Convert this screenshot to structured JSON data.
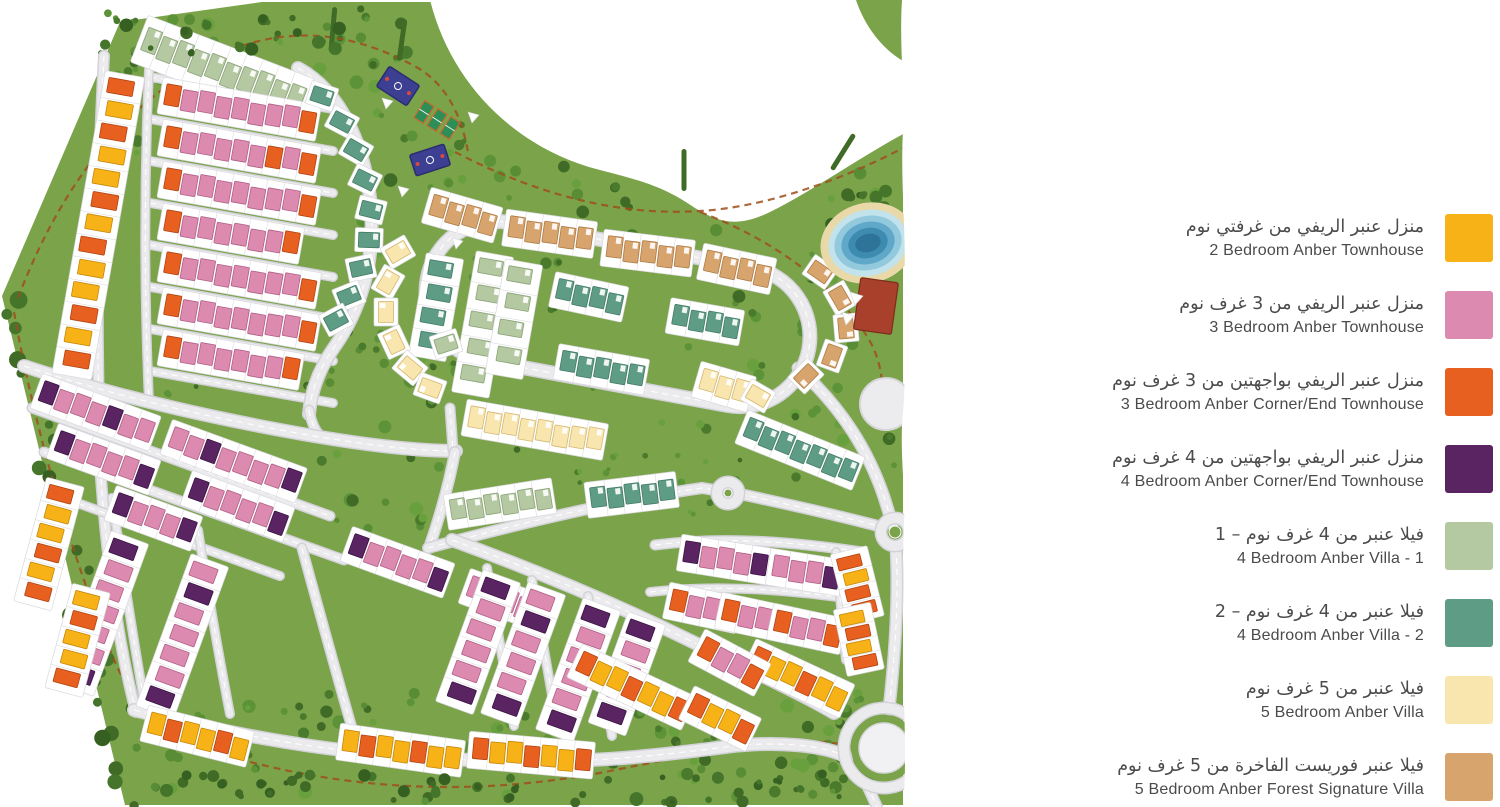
{
  "legend": {
    "items": [
      {
        "ar": "منزل عنبر الريفي من غرفتي نوم",
        "en": "2 Bedroom Anber Townhouse",
        "color": "#F7B217"
      },
      {
        "ar": "منزل عنبر الريفي من 3 غرف نوم",
        "en": "3 Bedroom Anber Townhouse",
        "color": "#DC8AB0"
      },
      {
        "ar": "منزل عنبر الريفي بواجهتين من 3 غرف نوم",
        "en": "3 Bedroom Anber Corner/End Townhouse",
        "color": "#E7601F"
      },
      {
        "ar": "منزل عنبر الريفي بواجهتين من 4 غرف نوم",
        "en": "4 Bedroom Anber Corner/End Townhouse",
        "color": "#5A2463"
      },
      {
        "ar": "فيلا عنبر من 4 غرف نوم – 1",
        "en": "4 Bedroom Anber Villa - 1",
        "color": "#B4C8A1"
      },
      {
        "ar": "فيلا عنبر من 4 غرف نوم – 2",
        "en": "4 Bedroom Anber Villa - 2",
        "color": "#5F9C86"
      },
      {
        "ar": "فيلا عنبر من 5 غرف نوم",
        "en": "5 Bedroom Anber Villa",
        "color": "#F9E5AE"
      },
      {
        "ar": "فيلا عنبر فوريست الفاخرة من 5 غرف نوم",
        "en": "5 Bedroom Anber Forest Signature Villa",
        "color": "#D8A46E"
      }
    ]
  },
  "map": {
    "bg": "#7BA34A",
    "page": "#ffffff",
    "road": {
      "casing": "#d2d2d8",
      "fill": "#ebebee",
      "dash": "#ffffff"
    },
    "trail_color": "#9f4f1d",
    "tree_colors": [
      "#4a7a2c",
      "#588c35",
      "#69a03e",
      "#3f6b26",
      "#5d9338"
    ],
    "dark_trees": [
      "#3f6b26",
      "#44752a",
      "#356022"
    ],
    "palette": {
      "Y": [
        "#F7B217",
        "#c4870a"
      ],
      "P": [
        "#DC8AB0",
        "#b05f85"
      ],
      "O": [
        "#E7601F",
        "#b04312"
      ],
      "U": [
        "#5A2463",
        "#3a1342"
      ],
      "S": [
        "#B4C8A1",
        "#8ba277"
      ],
      "T": [
        "#5F9C86",
        "#437b66"
      ],
      "C": [
        "#F9E5AE",
        "#d3b873"
      ],
      "N": [
        "#D8A46E",
        "#ad7b45"
      ]
    },
    "outline": "M 120,22 L 262,2 L 903,2 L 903,805 L 125,805 L 2,296 Z",
    "blob": "M 430,0 C 452,88 520,150 600,170 C 642,181 662,186 692,206 C 722,226 742,226 772,211 C 812,191 862,156 905,133 L 905,0 Z",
    "wedge": "M 856,0 C 866,30 886,52 905,62 L 905,0 Z",
    "blob_pts": [
      [
        425,
        0
      ],
      [
        500,
        118
      ],
      [
        560,
        158
      ],
      [
        620,
        172
      ],
      [
        680,
        200
      ],
      [
        740,
        218
      ],
      [
        800,
        196
      ],
      [
        860,
        162
      ],
      [
        905,
        133
      ]
    ],
    "edge": "M 902,0 C 899,45 905,90 903,130 C 900,185 907,235 904,290 C 901,340 907,375 903,412 C 899,452 906,492 904,522 C 902,560 906,600 904,640 C 902,700 908,750 903,807 L 920,807 L 920,0 Z",
    "trails": [
      "M 18,298 C 55,200 115,110 205,62 C 280,22 350,30 418,68 C 448,86 462,118 468,152",
      "M 455,152 C 540,196 620,216 700,211 C 770,207 850,176 903,148",
      "M 700,212 C 775,240 838,288 868,338 C 883,362 884,390 881,414",
      "M 14,312 C 35,430 70,550 110,650 C 125,688 144,716 170,737",
      "M 170,737 C 320,792 470,800 620,769 C 720,749 792,733 851,746"
    ],
    "roads": [
      {
        "d": "M 150,77 L 333,109",
        "w": 7
      },
      {
        "d": "M 150,119 L 333,151",
        "w": 7
      },
      {
        "d": "M 150,161 L 333,193",
        "w": 7
      },
      {
        "d": "M 150,203 L 333,235",
        "w": 7
      },
      {
        "d": "M 150,245 L 333,277",
        "w": 7
      },
      {
        "d": "M 150,287 L 333,319",
        "w": 7
      },
      {
        "d": "M 150,329 L 333,361",
        "w": 7
      },
      {
        "d": "M 150,371 L 333,403",
        "w": 7
      },
      {
        "d": "M 298,68 C 342,92 366,148 371,208 C 375,266 359,312 335,346 C 318,370 311,392 309,414",
        "w": 11
      },
      {
        "d": "M 309,410 C 312,426 317,434 324,439",
        "w": 8
      },
      {
        "d": "M 104,56 C 97,180 96,320 100,448",
        "w": 9
      },
      {
        "d": "M 149,70 C 144,180 144,290 149,402",
        "w": 7
      },
      {
        "d": "M 24,366 C 120,398 220,420 320,437 C 380,447 426,451 456,451",
        "w": 11
      },
      {
        "d": "M 99,446 C 104,540 117,640 136,712",
        "w": 9
      },
      {
        "d": "M 134,710 C 260,742 360,756 470,760 C 580,765 655,756 725,747 C 780,740 826,746 847,757",
        "w": 11
      },
      {
        "d": "M 867,785 L 877,807",
        "w": 9
      },
      {
        "d": "M 32,408 C 130,444 230,480 330,516",
        "w": 8
      },
      {
        "d": "M 44,452 C 144,488 244,524 344,560",
        "w": 8
      },
      {
        "d": "M 58,496 C 132,523 206,550 280,576",
        "w": 7
      },
      {
        "d": "M 112,498 C 122,565 132,632 144,700",
        "w": 7
      },
      {
        "d": "M 198,530 C 208,592 218,652 230,714",
        "w": 7
      },
      {
        "d": "M 302,548 C 320,614 338,680 356,742",
        "w": 8
      },
      {
        "d": "M 450,408 L 453,450",
        "w": 8
      },
      {
        "d": "M 455,452 C 449,484 440,516 429,548",
        "w": 9
      },
      {
        "d": "M 428,548 C 525,522 618,500 702,488 L 726,492",
        "w": 9
      },
      {
        "d": "M 452,540 C 540,572 625,608 705,648 C 758,674 802,694 834,713",
        "w": 11
      },
      {
        "d": "M 487,568 C 496,622 505,676 514,726",
        "w": 7
      },
      {
        "d": "M 532,580 C 541,630 549,678 557,724",
        "w": 7
      },
      {
        "d": "M 588,596 C 597,644 605,692 612,736",
        "w": 7
      },
      {
        "d": "M 655,545 C 725,536 795,542 862,552",
        "w": 8
      },
      {
        "d": "M 650,592 C 722,584 794,590 858,600",
        "w": 7
      },
      {
        "d": "M 740,494 C 792,505 840,516 882,527",
        "w": 9
      },
      {
        "d": "M 798,368 C 842,408 868,450 884,497 C 888,510 891,519 892,524",
        "w": 10
      },
      {
        "d": "M 896,547 C 899,600 895,655 889,709",
        "w": 10
      },
      {
        "d": "M 909,531 L 920,529",
        "w": 9
      },
      {
        "d": "M 836,552 C 840,590 842,625 846,660",
        "w": 7
      }
    ],
    "loop": {
      "x": 424,
      "y": 244,
      "w": 388,
      "h": 140,
      "r": 70,
      "rot": 10.5,
      "cx": 618,
      "cy": 314
    },
    "roundabouts": [
      {
        "cx": 728,
        "cy": 493,
        "r": 11,
        "ir": 4,
        "disc": false
      },
      {
        "cx": 895,
        "cy": 532,
        "r": 14,
        "ir": 6,
        "disc": false
      },
      {
        "cx": 884,
        "cy": 748,
        "r": 40,
        "ir": 25,
        "disc": true
      }
    ],
    "clusters": [
      {
        "x": 143,
        "y": 40,
        "rot": 21,
        "p": "SSSSSSSSSS",
        "uh": 24,
        "deep": true
      },
      {
        "x": 124,
        "y": 80,
        "rot": 10,
        "axis": "v",
        "p": "OYOYYOYOYYOYO",
        "uw": 26,
        "uh": 15,
        "pv": 23
      },
      {
        "x": 164,
        "y": 96,
        "rot": 10,
        "p": "OPPPPPPPO"
      },
      {
        "x": 164,
        "y": 138,
        "rot": 10,
        "p": "OPPPPPOPO"
      },
      {
        "x": 164,
        "y": 180,
        "rot": 10,
        "p": "OPPPPPPPO"
      },
      {
        "x": 164,
        "y": 222,
        "rot": 10,
        "p": "OPPPPPPO"
      },
      {
        "x": 164,
        "y": 264,
        "rot": 10,
        "p": "OPPPPPPPO"
      },
      {
        "x": 164,
        "y": 306,
        "rot": 10,
        "p": "OPPPPPPPO"
      },
      {
        "x": 164,
        "y": 348,
        "rot": 10,
        "p": "OPPPPPPO"
      },
      {
        "x": 40,
        "y": 392,
        "rot": 20,
        "p": "UPPPUPP"
      },
      {
        "x": 170,
        "y": 438,
        "rot": 20,
        "p": "PPUPPPPU"
      },
      {
        "x": 56,
        "y": 442,
        "rot": 20,
        "p": "UPPPPU"
      },
      {
        "x": 190,
        "y": 489,
        "rot": 20,
        "p": "UPPPPU"
      },
      {
        "x": 350,
        "y": 545,
        "rot": 20,
        "p": "UPPPPU"
      },
      {
        "x": 468,
        "y": 587,
        "rot": 20,
        "p": "PUPPU"
      },
      {
        "x": 114,
        "y": 504,
        "rot": 20,
        "p": "UPPPU"
      },
      {
        "x": 128,
        "y": 543,
        "rot": 20,
        "axis": "v",
        "p": "UPPPPPU",
        "uw": 26,
        "uh": 15,
        "pv": 22
      },
      {
        "x": 208,
        "y": 566,
        "rot": 20,
        "axis": "v",
        "p": "PUPPPPU",
        "uw": 26,
        "uh": 15,
        "pv": 22
      },
      {
        "x": 500,
        "y": 582,
        "rot": 20,
        "axis": "v",
        "p": "UPPPPU",
        "uw": 26,
        "uh": 15,
        "pv": 22
      },
      {
        "x": 545,
        "y": 594,
        "rot": 20,
        "axis": "v",
        "p": "PUPPPU",
        "uw": 26,
        "uh": 15,
        "pv": 22
      },
      {
        "x": 600,
        "y": 610,
        "rot": 20,
        "axis": "v",
        "p": "UPPPPU",
        "uw": 26,
        "uh": 15,
        "pv": 22
      },
      {
        "x": 645,
        "y": 624,
        "rot": 20,
        "axis": "v",
        "p": "UPPPU",
        "uw": 26,
        "uh": 15,
        "pv": 22
      },
      {
        "x": 64,
        "y": 488,
        "rot": 15,
        "axis": "v",
        "p": "OYYOYO",
        "uw": 25,
        "uh": 14,
        "pv": 20
      },
      {
        "x": 90,
        "y": 594,
        "rot": 15,
        "axis": "v",
        "p": "YOYYO",
        "uw": 25,
        "uh": 14,
        "pv": 20
      },
      {
        "x": 148,
        "y": 724,
        "rot": 14,
        "p": "YOYYOY"
      },
      {
        "x": 342,
        "y": 742,
        "rot": 8,
        "p": "YOYYOYY"
      },
      {
        "x": 472,
        "y": 750,
        "rot": 5,
        "p": "OYYOYYO"
      },
      {
        "x": 578,
        "y": 662,
        "rot": 25,
        "p": "OYYOYYO"
      },
      {
        "x": 690,
        "y": 704,
        "rot": 26,
        "p": "OYYO"
      },
      {
        "x": 752,
        "y": 657,
        "rot": 25,
        "p": "OYYOYY"
      },
      {
        "x": 683,
        "y": 553,
        "rot": 9,
        "p": "UPPPU"
      },
      {
        "x": 772,
        "y": 567,
        "rot": 9,
        "p": "PPPU"
      },
      {
        "x": 670,
        "y": 601,
        "rot": 12,
        "p": "OPPO"
      },
      {
        "x": 722,
        "y": 611,
        "rot": 12,
        "p": "OPPO"
      },
      {
        "x": 774,
        "y": 622,
        "rot": 12,
        "p": "OPPO"
      },
      {
        "x": 700,
        "y": 647,
        "rot": 28,
        "p": "OPPO"
      },
      {
        "x": 850,
        "y": 556,
        "rot": -14,
        "axis": "v",
        "p": "OYOO",
        "uw": 24,
        "uh": 12,
        "pv": 16
      },
      {
        "x": 853,
        "y": 612,
        "rot": -12,
        "axis": "v",
        "p": "YOYO",
        "uw": 24,
        "uh": 12,
        "pv": 15
      },
      {
        "x": 450,
        "y": 512,
        "rot": -9,
        "p": "SSSSSS",
        "uh": 20
      },
      {
        "x": 590,
        "y": 500,
        "rot": -7,
        "p": "TTTTT",
        "uh": 20
      },
      {
        "x": 745,
        "y": 428,
        "rot": 22,
        "p": "TTTTTTT",
        "uh": 20
      },
      {
        "x": 444,
        "y": 262,
        "rot": 10,
        "axis": "v",
        "p": "TTTT",
        "uw": 24,
        "uh": 15,
        "pv": 24
      },
      {
        "x": 494,
        "y": 260,
        "rot": 10,
        "axis": "v",
        "p": "SSSSS",
        "uw": 24,
        "uh": 15,
        "pv": 27
      },
      {
        "x": 523,
        "y": 268,
        "rot": 10,
        "axis": "v",
        "p": "SSSS",
        "uw": 24,
        "uh": 15,
        "pv": 27
      },
      {
        "x": 556,
        "y": 290,
        "rot": 12,
        "p": "TTTT",
        "uh": 20
      },
      {
        "x": 672,
        "y": 316,
        "rot": 10,
        "p": "TTTT",
        "uh": 20
      },
      {
        "x": 560,
        "y": 362,
        "rot": 10,
        "p": "TTTTT",
        "uh": 20
      },
      {
        "x": 468,
        "y": 418,
        "rot": 10,
        "p": "CCCCCCCC"
      },
      {
        "x": 700,
        "y": 380,
        "rot": 16,
        "p": "CCC"
      },
      {
        "x": 430,
        "y": 206,
        "rot": 16,
        "p": "NNNN"
      },
      {
        "x": 508,
        "y": 228,
        "rot": 8,
        "p": "NNNNN"
      },
      {
        "x": 606,
        "y": 248,
        "rot": 7,
        "p": "NNNNN"
      },
      {
        "x": 704,
        "y": 262,
        "rot": 12,
        "p": "NNNN"
      }
    ],
    "singles": [
      [
        322,
        96,
        18,
        "T"
      ],
      [
        342,
        122,
        28,
        "T"
      ],
      [
        356,
        150,
        30,
        "T"
      ],
      [
        365,
        180,
        26,
        "T"
      ],
      [
        371,
        210,
        14,
        "T"
      ],
      [
        369,
        240,
        2,
        "T"
      ],
      [
        361,
        268,
        -12,
        "T"
      ],
      [
        349,
        296,
        -22,
        "T"
      ],
      [
        336,
        320,
        -28,
        "T"
      ],
      [
        820,
        272,
        35,
        "N"
      ],
      [
        840,
        298,
        60,
        "N"
      ],
      [
        846,
        328,
        85,
        "N"
      ],
      [
        832,
        356,
        110,
        "N"
      ],
      [
        806,
        376,
        135,
        "N"
      ],
      [
        398,
        252,
        -30,
        "C"
      ],
      [
        388,
        282,
        -60,
        "C"
      ],
      [
        386,
        312,
        -90,
        "C"
      ],
      [
        394,
        342,
        -115,
        "C"
      ],
      [
        410,
        368,
        -140,
        "C"
      ],
      [
        430,
        388,
        -160,
        "C"
      ],
      [
        758,
        396,
        30,
        "C"
      ],
      [
        446,
        344,
        -18,
        "S"
      ]
    ],
    "tree_zones": [
      {
        "x": 95,
        "y": 8,
        "w": 320,
        "h": 85,
        "n": 38
      },
      {
        "x": 360,
        "y": 85,
        "w": 290,
        "h": 185,
        "n": 55
      },
      {
        "x": 700,
        "y": 168,
        "w": 200,
        "h": 310,
        "n": 55
      },
      {
        "x": 320,
        "y": 330,
        "w": 150,
        "h": 215,
        "n": 30
      },
      {
        "x": 130,
        "y": 690,
        "w": 750,
        "h": 112,
        "n": 80
      },
      {
        "x": 440,
        "y": 250,
        "w": 360,
        "h": 200,
        "n": 20,
        "small": true
      },
      {
        "x": 845,
        "y": 2,
        "w": 58,
        "h": 62,
        "n": 14,
        "dark": true
      },
      {
        "x": 140,
        "y": 360,
        "w": 190,
        "h": 48,
        "n": 12,
        "small": true
      },
      {
        "x": 820,
        "y": 185,
        "w": 85,
        "h": 50,
        "n": 18,
        "dark": true
      },
      {
        "x": 540,
        "y": 455,
        "w": 200,
        "h": 60,
        "n": 16,
        "small": true
      },
      {
        "x": 660,
        "y": 700,
        "w": 220,
        "h": 80,
        "n": 25
      },
      {
        "x": 88,
        "y": 95,
        "w": 70,
        "h": 60,
        "n": 10
      }
    ],
    "edge_bands": [
      {
        "x": 140,
        "y": 775,
        "w": 730,
        "h": 28,
        "n": 42,
        "dark": true
      },
      {
        "x": 100,
        "y": 16,
        "w": 240,
        "h": 40,
        "n": 16,
        "dark": true
      }
    ],
    "left_diag": {
      "x1": 4,
      "y1": 298,
      "x2": 122,
      "y2": 800,
      "n": 28
    },
    "hedges": [
      [
        843,
        152,
        32
      ],
      [
        684,
        170,
        0
      ],
      [
        402,
        40,
        8
      ],
      [
        333,
        28,
        5
      ]
    ],
    "lake": {
      "cx": 868,
      "cy": 243,
      "rot": -15,
      "rings": [
        [
          "#e9d9a8",
          48,
          40
        ],
        [
          "#c2e2ec",
          40,
          33
        ],
        [
          "#93c9dd",
          34,
          27
        ],
        [
          "#5fa8c9",
          27,
          21
        ],
        [
          "#3e8bb0",
          20,
          15
        ],
        [
          "#2e7398",
          13,
          9
        ]
      ]
    },
    "plaza": {
      "cx": 886,
      "cy": 404,
      "r": 26
    },
    "red_building": {
      "x": 876,
      "y": 306,
      "w": 38,
      "h": 52,
      "rot": 8,
      "fill": "#a8402c",
      "stroke": "#7e2c1d"
    },
    "playground": {
      "court_fill": "#3d3f92",
      "court_stroke": "#2b2d70",
      "pitch_fill": "#2e8e57",
      "pitch_stroke": "#c96a2f",
      "blue1": {
        "x": 398,
        "y": 86,
        "w": 36,
        "h": 24,
        "rot": 33
      },
      "blue2": {
        "x": 430,
        "y": 160,
        "w": 36,
        "h": 22,
        "rot": -18
      },
      "pitches": [
        [
          424,
          112
        ],
        [
          437,
          120
        ],
        [
          450,
          128
        ]
      ],
      "sails": [
        [
          382,
          98
        ],
        [
          468,
          112
        ],
        [
          398,
          186
        ],
        [
          452,
          238
        ]
      ]
    }
  }
}
